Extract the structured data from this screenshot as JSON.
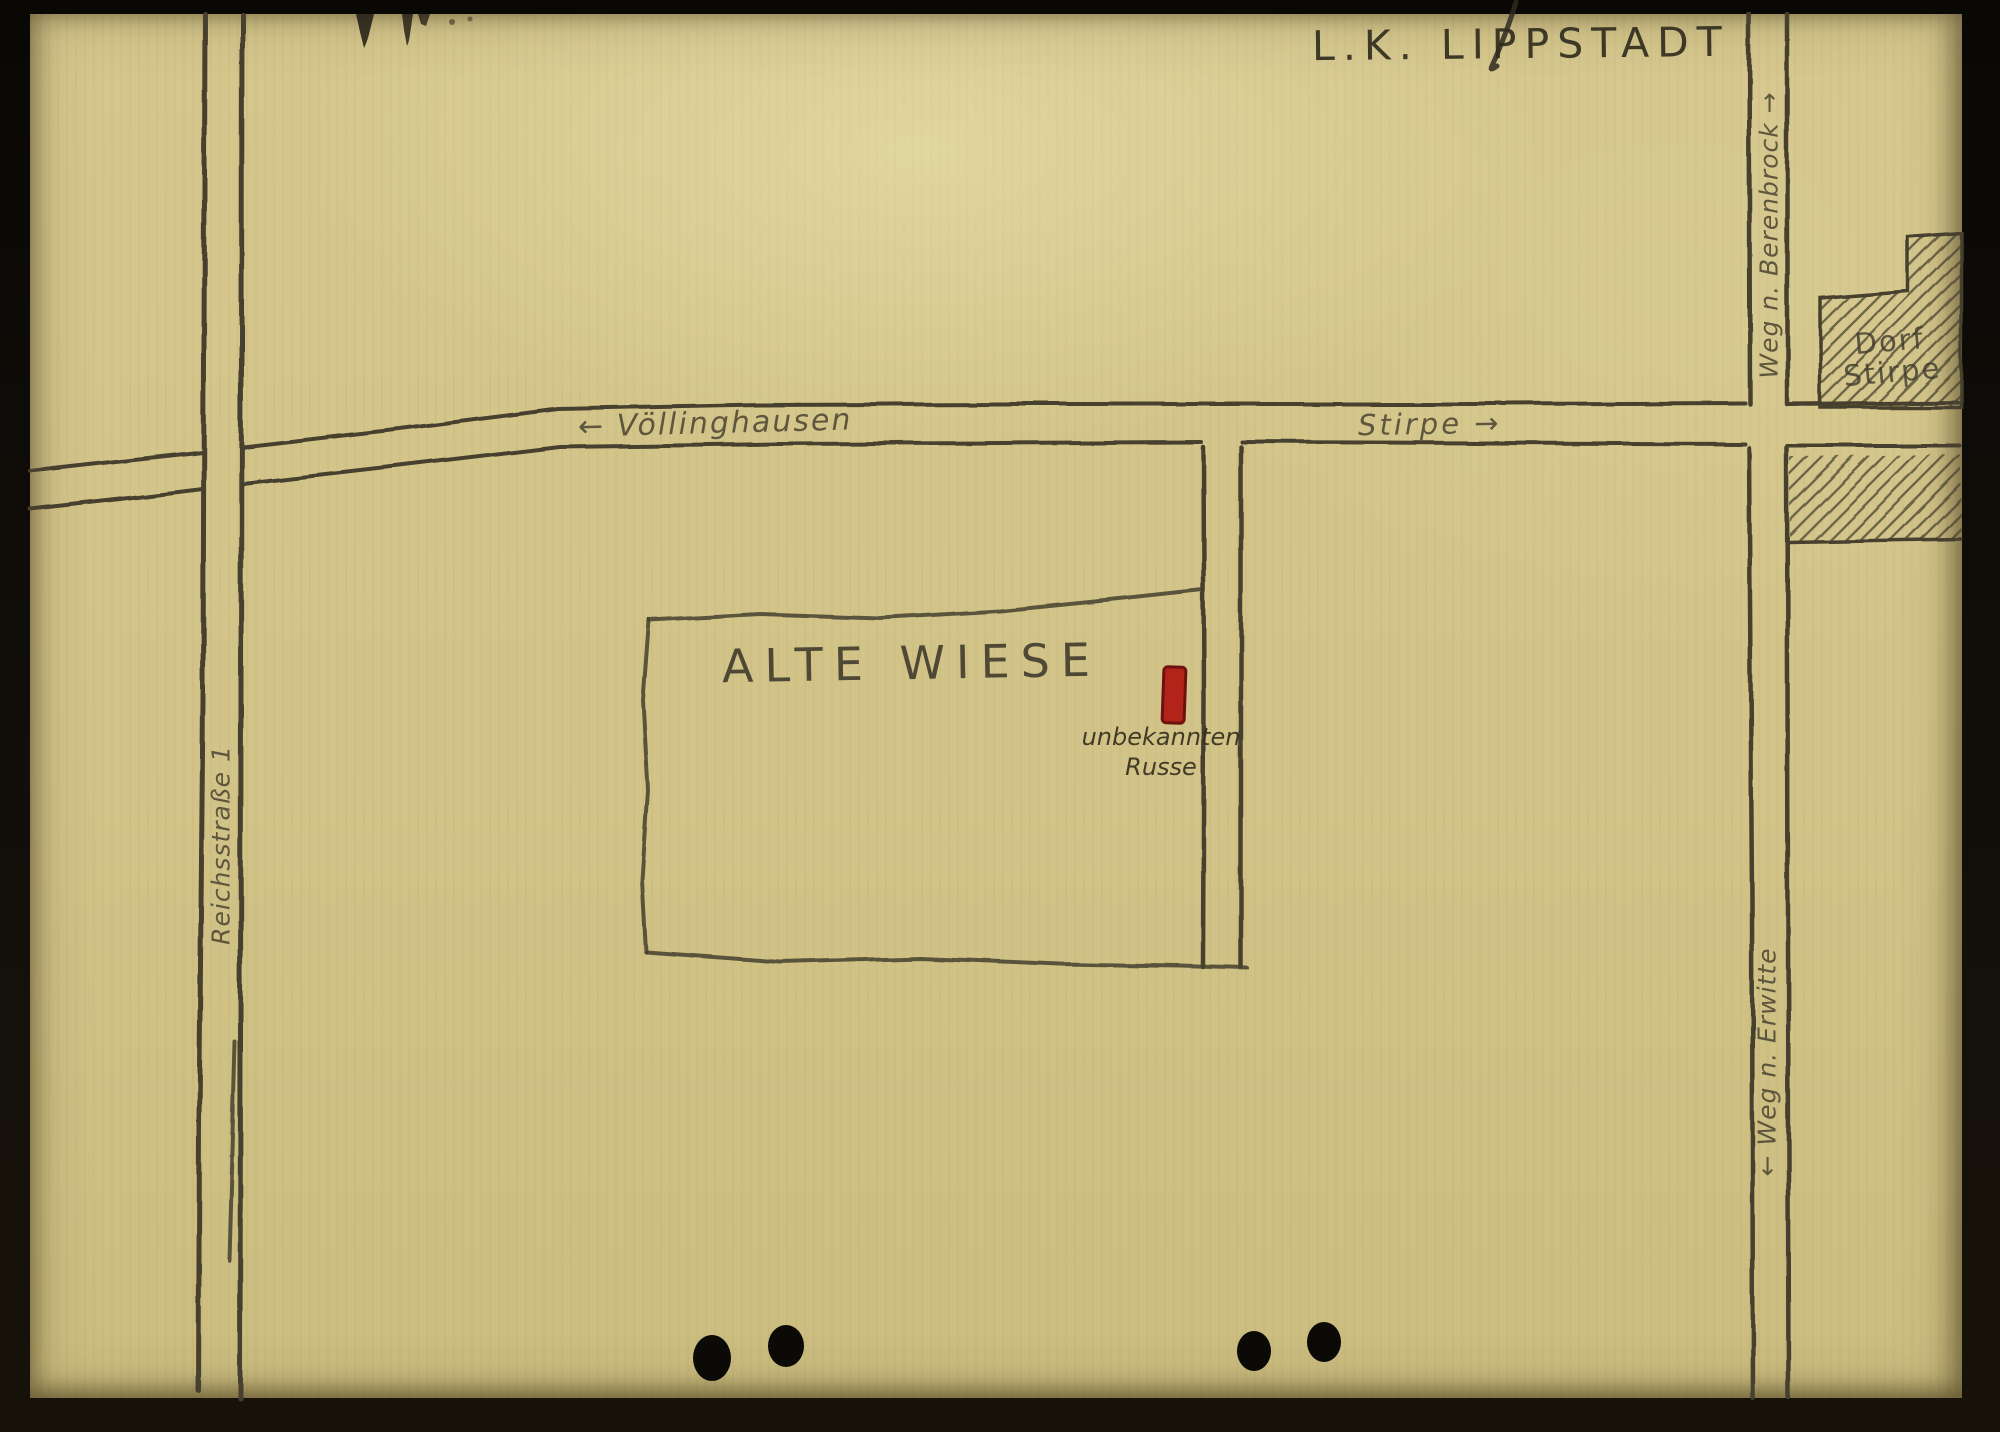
{
  "map": {
    "title": "L.K. LIPPSTADT",
    "field_label": "ALTE WIESE",
    "village": {
      "line1": "Dorf",
      "line2": "Stirpe"
    },
    "marker": {
      "line1": "unbekannten",
      "line2": "Russe",
      "color": "#b2231a"
    },
    "roads": {
      "west": {
        "arrow": "←",
        "label": "Völlinghausen"
      },
      "east": {
        "label": "Stirpe",
        "arrow": "→"
      },
      "north": {
        "label": "Weg n. Berenbrock",
        "arrow": "→"
      },
      "south": {
        "arrow": "←",
        "label": "Weg n. Erwitte"
      },
      "highway": {
        "label": "Reichsstraße 1"
      }
    },
    "colors": {
      "paper": "#d2c488",
      "pencil": "#45402f",
      "frame": "#100d08"
    }
  }
}
